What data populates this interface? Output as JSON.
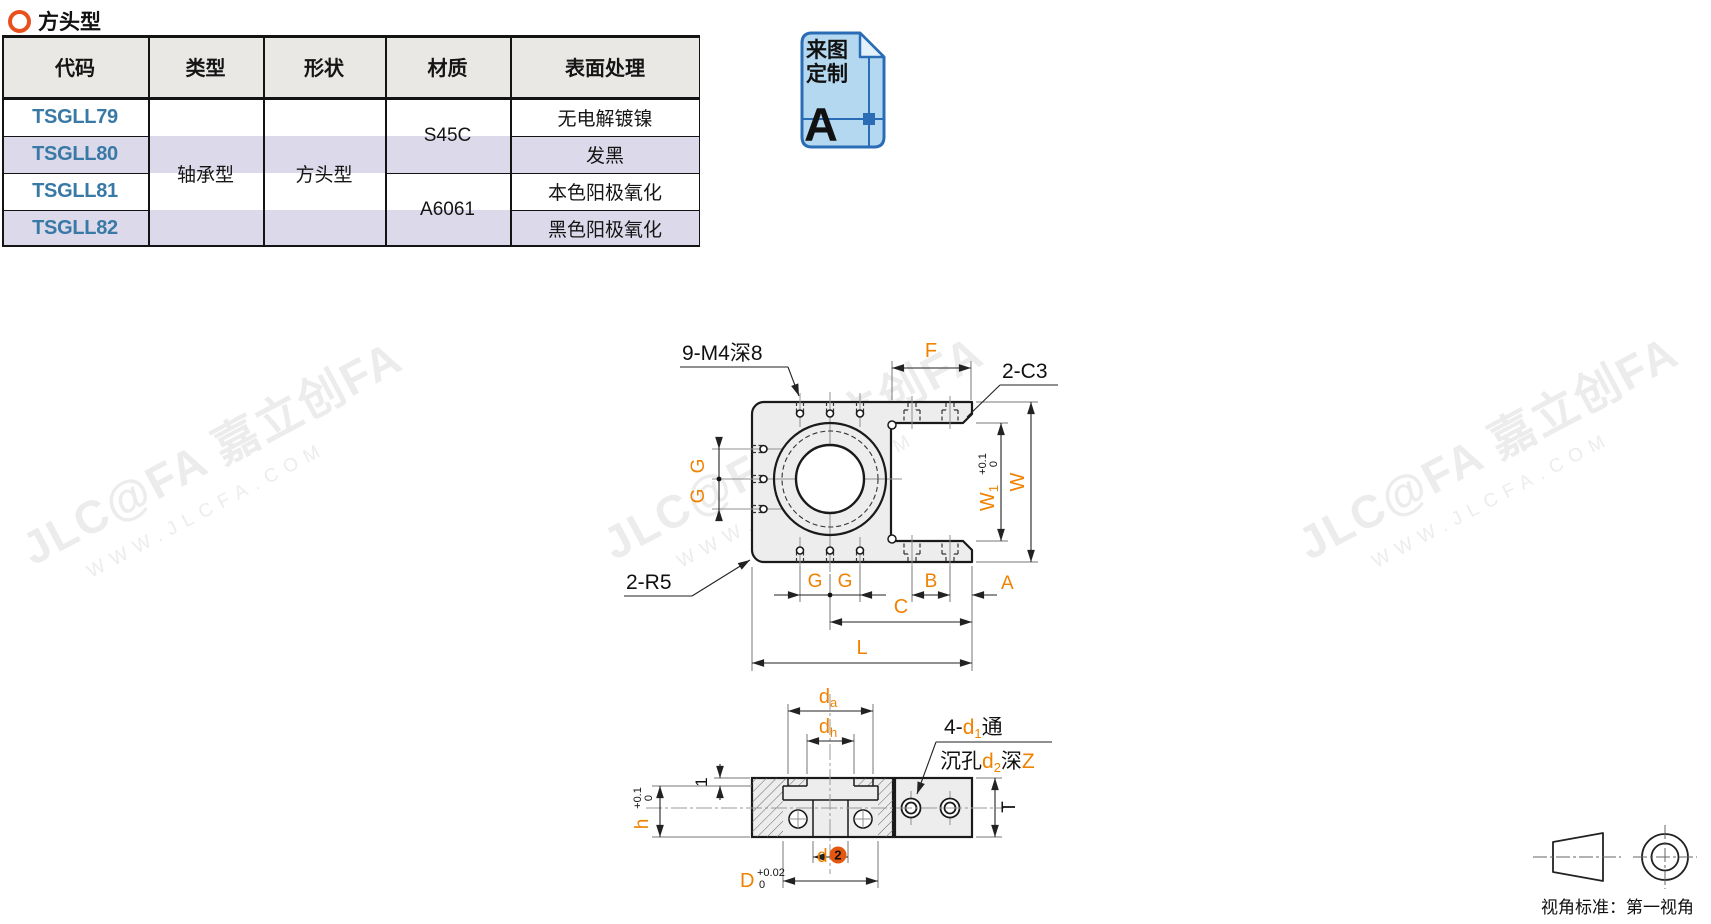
{
  "heading": {
    "title": "方头型"
  },
  "table": {
    "headers": [
      "代码",
      "类型",
      "形状",
      "材质",
      "表面处理"
    ],
    "rows": {
      "codes": [
        "TSGLL79",
        "TSGLL80",
        "TSGLL81",
        "TSGLL82"
      ],
      "type": "轴承型",
      "shape": "方头型",
      "materials": [
        "S45C",
        "A6061"
      ],
      "surfaces": [
        "无电解镀镍",
        "发黑",
        "本色阳极氧化",
        "黑色阳极氧化"
      ]
    }
  },
  "custom_badge": {
    "line1": "来图",
    "line2": "定制",
    "letter": "A"
  },
  "watermark": {
    "brand": "JLC@FA 嘉立创FA",
    "site": "WWW.JLCFA.COM"
  },
  "top_view": {
    "thread_note": "9-M4深8",
    "chamfer_note": "2-C3",
    "radius_note": "2-R5",
    "dim_f": "F",
    "dim_g": "G",
    "dim_b": "B",
    "dim_a": "A",
    "dim_c": "C",
    "dim_l": "L",
    "dim_w": "W",
    "dim_w1": {
      "main": "W",
      "sub": "1",
      "tol_up": "+0.1",
      "tol_dn": "0"
    }
  },
  "section_view": {
    "dim_da": {
      "main": "d",
      "sub": "a"
    },
    "dim_dh": {
      "main": "d",
      "sub": "h"
    },
    "note_through": {
      "prefix": "4-",
      "d": "d",
      "sub": "1",
      "suffix": "通"
    },
    "note_cbore": {
      "prefix": "沉孔",
      "d": "d",
      "sub": "2",
      "mid": "深",
      "z": "Z"
    },
    "dim_lip": "1",
    "dim_h": {
      "main": "h",
      "tol_up": "+0.1",
      "tol_dn": "0"
    },
    "dim_d": "d",
    "callout_num": "2",
    "dim_D": {
      "main": "D",
      "tol_up": "+0.02",
      "tol_dn": "0"
    },
    "dim_t": "T"
  },
  "projection": {
    "label": "视角标准：第一视角"
  },
  "colors": {
    "accent_orange": "#F08200",
    "code_link_blue": "#3879A5",
    "badge_blue": "#2A6CB5",
    "badge_fill": "#B5D8F1",
    "callout_orange": "#E4570F",
    "row_stripe": "#DCDAEA",
    "header_bg": "#E9E8E5",
    "heading_ring": "#E8501E",
    "part_fill": "#EDEDED"
  }
}
